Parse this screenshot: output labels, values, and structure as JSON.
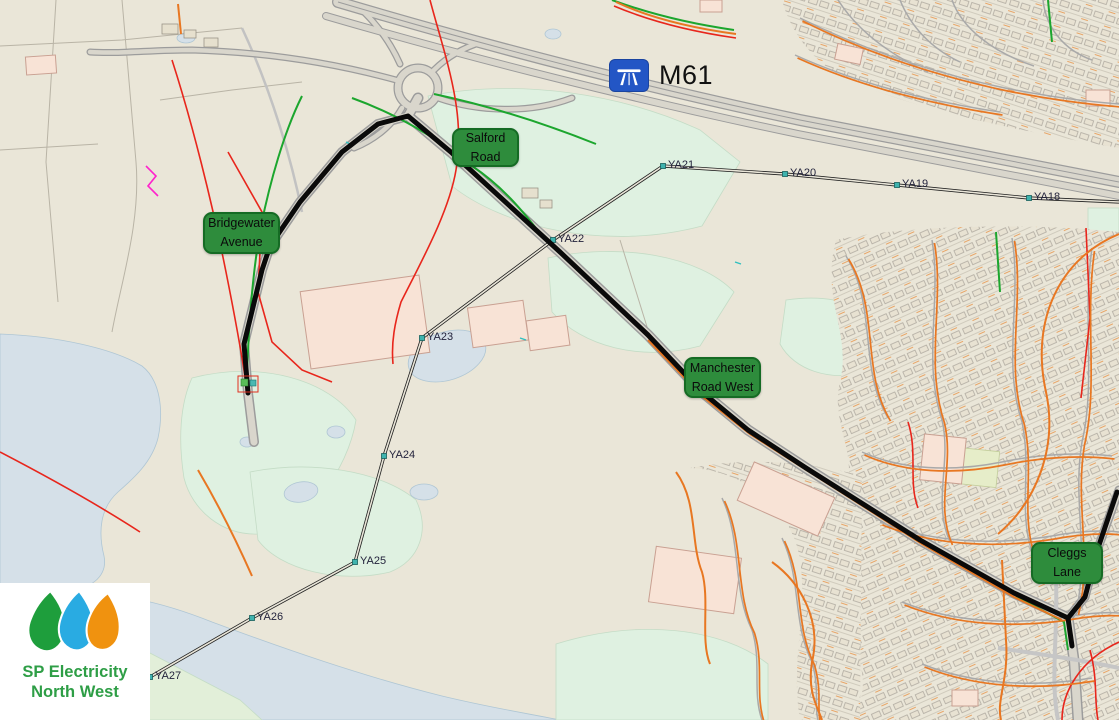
{
  "map": {
    "motorway_label": "M61",
    "street_labels": [
      {
        "id": "salford-road",
        "line1": "Salford",
        "line2": "Road",
        "x": 452,
        "y": 128,
        "w": 67,
        "h": 39
      },
      {
        "id": "bridgewater-avenue",
        "line1": "Bridgewater",
        "line2": "Avenue",
        "x": 203,
        "y": 212,
        "w": 77,
        "h": 42
      },
      {
        "id": "manchester-road-west",
        "line1": "Manchester",
        "line2": "Road West",
        "x": 684,
        "y": 357,
        "w": 77,
        "h": 41
      },
      {
        "id": "cleggs-lane",
        "line1": "Cleggs",
        "line2": "Lane",
        "x": 1031,
        "y": 542,
        "w": 72,
        "h": 42
      }
    ],
    "pylons": [
      {
        "label": "YA18",
        "x": 1029,
        "y": 198
      },
      {
        "label": "YA19",
        "x": 897,
        "y": 185
      },
      {
        "label": "YA20",
        "x": 785,
        "y": 174
      },
      {
        "label": "YA21",
        "x": 663,
        "y": 166
      },
      {
        "label": "YA22",
        "x": 553,
        "y": 240
      },
      {
        "label": "YA23",
        "x": 422,
        "y": 338
      },
      {
        "label": "YA24",
        "x": 384,
        "y": 456
      },
      {
        "label": "YA25",
        "x": 355,
        "y": 562
      },
      {
        "label": "YA26",
        "x": 252,
        "y": 618
      },
      {
        "label": "YA27",
        "x": 150,
        "y": 677
      }
    ],
    "colors": {
      "base": "#EAE6D8",
      "water": "#D5E0E8",
      "field_mint": "#DFF1E1",
      "building_pink": "#F8E3D6",
      "label_green": "#2E8C3C",
      "label_border": "#156B24",
      "route_black": "#0A0A0A",
      "pylon_teal": "#3FB3AE",
      "motorway_blue": "#2356C5",
      "cable_orange": "#E87722",
      "cable_red": "#E8261C",
      "cable_green": "#1CA62E",
      "cable_magenta": "#FF22CC"
    }
  },
  "logo": {
    "line1": "SP Electricity",
    "line2": "North West",
    "drop_colors": [
      "#1E9E3C",
      "#29ABE2",
      "#F0920F"
    ]
  }
}
